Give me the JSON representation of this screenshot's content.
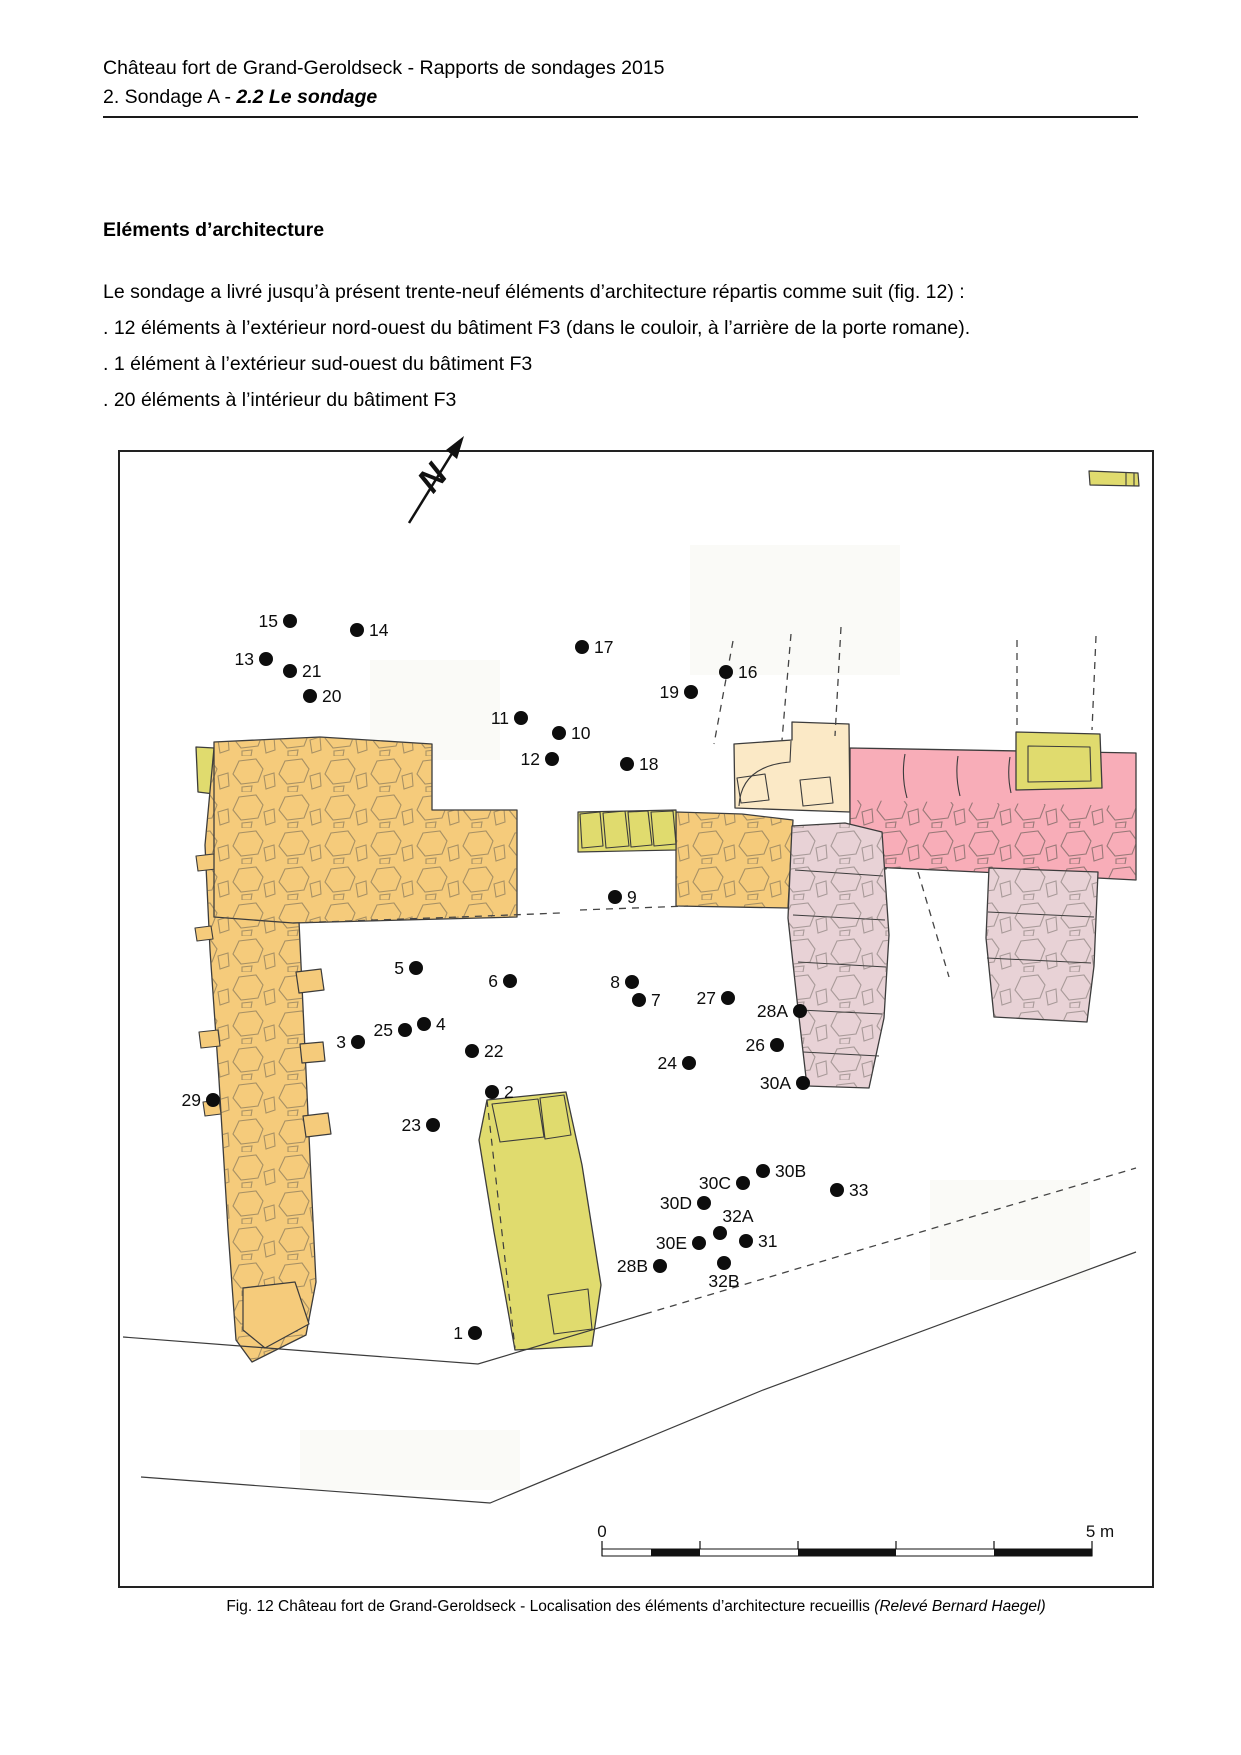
{
  "header": {
    "line1": "Château fort de Grand-Geroldseck - Rapports de sondages 2015",
    "line2_prefix": "2. Sondage A - ",
    "line2_emph": "2.2 Le sondage"
  },
  "section": {
    "heading": "Eléments d’architecture",
    "paragraph": "Le sondage a livré jusqu’à présent trente-neuf éléments d’architecture répartis comme suit (fig. 12) :",
    "bullets": [
      ". 12 éléments à l’extérieur nord-ouest du bâtiment F3 (dans le couloir, à l’arrière de la porte romane).",
      ". 1 élément à l’extérieur sud-ouest du bâtiment F3",
      ". 20 éléments à l’intérieur du bâtiment F3"
    ]
  },
  "figure": {
    "caption_main": "Fig. 12 Château fort de Grand-Geroldseck - Localisation des éléments d’architecture recueillis ",
    "caption_italic": "(Relevé Bernard Haegel)",
    "north_label": "N",
    "scale": {
      "zero_label": "0",
      "max_label": "5 m"
    },
    "colors": {
      "orange": "#F5CB7B",
      "cream": "#FBE9C6",
      "pink": "#F8ADB8",
      "lime": "#E0DB6E",
      "mauve": "#E8D2D6",
      "outline": "#3c3c3c"
    },
    "points": [
      {
        "id": "1",
        "x": 475,
        "y": 1333,
        "side": "l"
      },
      {
        "id": "2",
        "x": 492,
        "y": 1092,
        "side": "r"
      },
      {
        "id": "3",
        "x": 358,
        "y": 1042,
        "side": "l"
      },
      {
        "id": "4",
        "x": 424,
        "y": 1024,
        "side": "r"
      },
      {
        "id": "5",
        "x": 416,
        "y": 968,
        "side": "l"
      },
      {
        "id": "6",
        "x": 510,
        "y": 981,
        "side": "l"
      },
      {
        "id": "7",
        "x": 639,
        "y": 1000,
        "side": "r"
      },
      {
        "id": "8",
        "x": 632,
        "y": 982,
        "side": "l"
      },
      {
        "id": "9",
        "x": 615,
        "y": 897,
        "side": "r"
      },
      {
        "id": "10",
        "x": 559,
        "y": 733,
        "side": "r"
      },
      {
        "id": "11",
        "x": 521,
        "y": 718,
        "side": "l"
      },
      {
        "id": "12",
        "x": 552,
        "y": 759,
        "side": "l"
      },
      {
        "id": "13",
        "x": 266,
        "y": 659,
        "side": "l"
      },
      {
        "id": "14",
        "x": 357,
        "y": 630,
        "side": "r"
      },
      {
        "id": "15",
        "x": 290,
        "y": 621,
        "side": "l"
      },
      {
        "id": "16",
        "x": 726,
        "y": 672,
        "side": "r"
      },
      {
        "id": "17",
        "x": 582,
        "y": 647,
        "side": "r"
      },
      {
        "id": "18",
        "x": 627,
        "y": 764,
        "side": "r"
      },
      {
        "id": "19",
        "x": 691,
        "y": 692,
        "side": "l"
      },
      {
        "id": "20",
        "x": 310,
        "y": 696,
        "side": "r"
      },
      {
        "id": "21",
        "x": 290,
        "y": 671,
        "side": "r"
      },
      {
        "id": "22",
        "x": 472,
        "y": 1051,
        "side": "r"
      },
      {
        "id": "23",
        "x": 433,
        "y": 1125,
        "side": "l"
      },
      {
        "id": "24",
        "x": 689,
        "y": 1063,
        "side": "l"
      },
      {
        "id": "25",
        "x": 405,
        "y": 1030,
        "side": "l"
      },
      {
        "id": "26",
        "x": 777,
        "y": 1045,
        "side": "l"
      },
      {
        "id": "27",
        "x": 728,
        "y": 998,
        "side": "l"
      },
      {
        "id": "28A",
        "x": 800,
        "y": 1011,
        "side": "l"
      },
      {
        "id": "28B",
        "x": 660,
        "y": 1266,
        "side": "l"
      },
      {
        "id": "29",
        "x": 213,
        "y": 1100,
        "side": "l"
      },
      {
        "id": "30A",
        "x": 803,
        "y": 1083,
        "side": "l"
      },
      {
        "id": "30B",
        "x": 763,
        "y": 1171,
        "side": "r"
      },
      {
        "id": "30C",
        "x": 743,
        "y": 1183,
        "side": "l"
      },
      {
        "id": "30D",
        "x": 704,
        "y": 1203,
        "side": "l"
      },
      {
        "id": "30E",
        "x": 699,
        "y": 1243,
        "side": "l"
      },
      {
        "id": "31",
        "x": 746,
        "y": 1241,
        "side": "r"
      },
      {
        "id": "32A",
        "x": 720,
        "y": 1233,
        "side": "a"
      },
      {
        "id": "32B",
        "x": 724,
        "y": 1263,
        "side": "b"
      },
      {
        "id": "33",
        "x": 837,
        "y": 1190,
        "side": "r"
      }
    ]
  }
}
